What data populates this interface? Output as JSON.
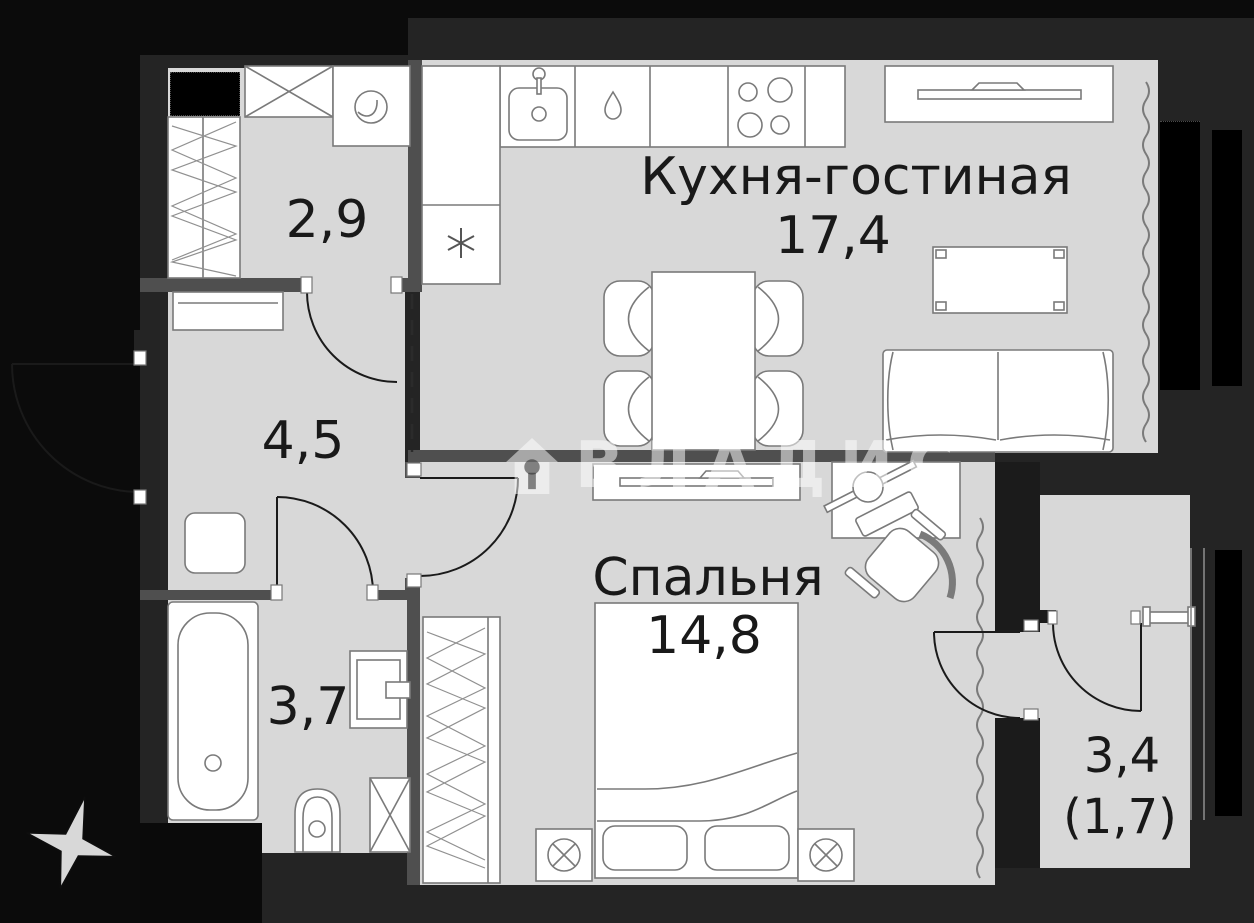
{
  "plan": {
    "watermark": "ВЛАДИС",
    "rooms": {
      "kitchen_living": {
        "name": "Кухня-гостиная",
        "area": "17,4"
      },
      "wardrobe_room": {
        "area": "2,9"
      },
      "hallway": {
        "area": "4,5"
      },
      "bedroom": {
        "name": "Спальня",
        "area": "14,8"
      },
      "bathroom": {
        "area": "3,7"
      },
      "balcony": {
        "area": "3,4",
        "area_secondary": "(1,7)"
      }
    },
    "colors": {
      "background": "#0b0b0b",
      "wall": "#242424",
      "inner_wall": "#4f4f4f",
      "floor": "#d8d8d8",
      "furniture_line": "#7a7a7a",
      "text": "#191919",
      "watermark": "#ffffff"
    },
    "icons": [
      "washing-machine-icon",
      "kitchen-sink-icon",
      "stove-burners-icon",
      "fridge-asterisk-icon",
      "dishwasher-drop-icon",
      "tv-icon",
      "sofa-icon",
      "dining-table-icon",
      "coffee-table-icon",
      "bed-icon",
      "nightstand-lamp-icon",
      "desk-icon",
      "office-chair-icon",
      "wardrobe-hatch-icon",
      "bathtub-icon",
      "toilet-icon",
      "washbasin-icon",
      "door-arc-icon",
      "radiator-wave-icon",
      "compass-star-icon",
      "house-logo-icon"
    ]
  }
}
